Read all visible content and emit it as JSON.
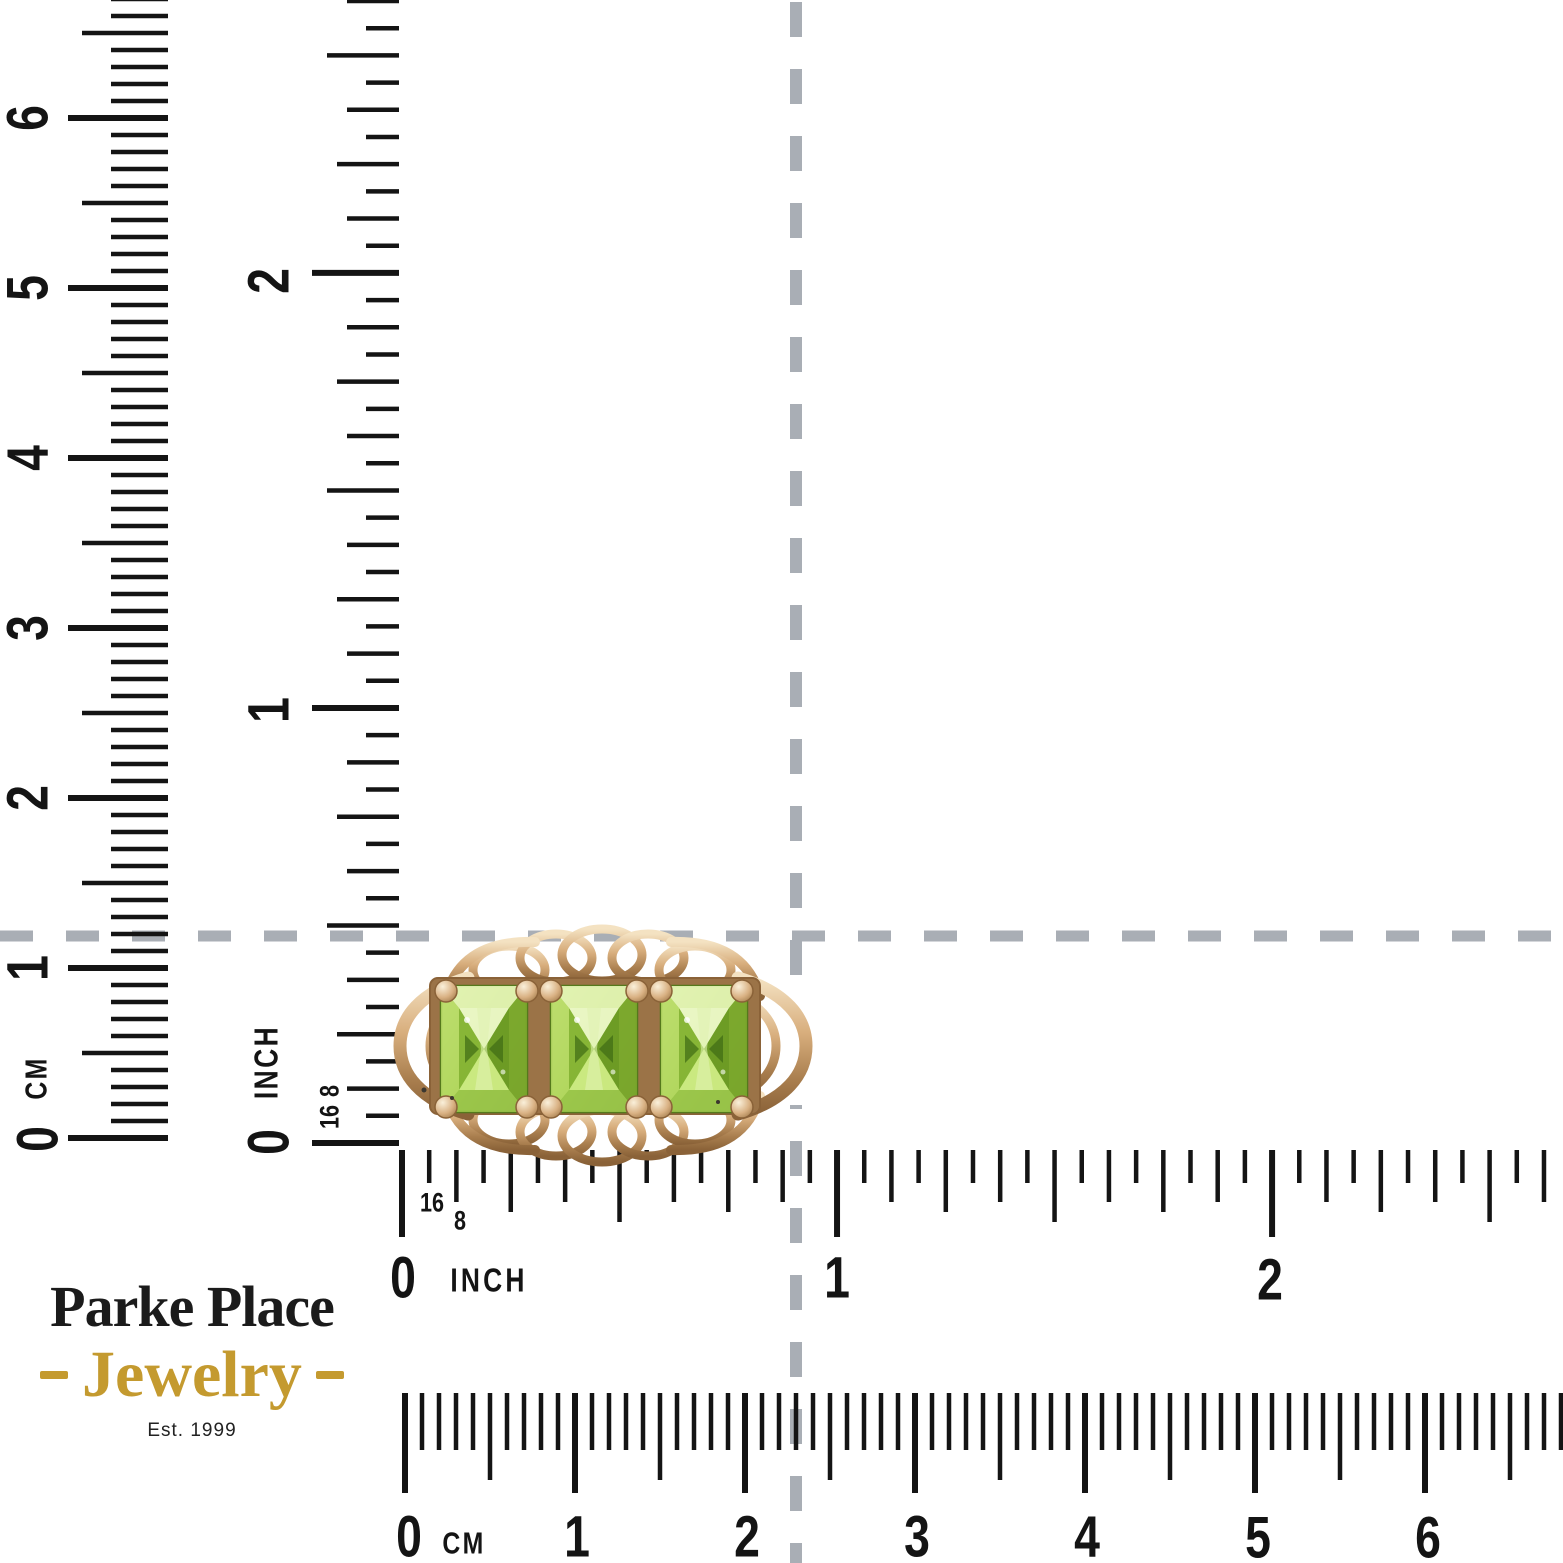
{
  "page": {
    "width": 1563,
    "height": 1563,
    "background": "#ffffff"
  },
  "brand": {
    "name_line": "Parke Place",
    "jewelry_line": "Jewelry",
    "established": "Est. 1999",
    "name_color": "#1b1b1b",
    "accent_color": "#c49a2f",
    "est_color": "#222222"
  },
  "crosshair": {
    "color": "#a9aeb5",
    "vertical": {
      "x": 796,
      "width": 12,
      "dash": 35,
      "gap": 32
    },
    "horizontal": {
      "y": 936,
      "width": 11,
      "dash": 33,
      "gap": 33
    }
  },
  "ring": {
    "description": "three-stone emerald-cut peridot ring in yellow gold",
    "stone_xs": [
      441,
      551,
      661
    ],
    "stone_w": 86,
    "stone_top": 986,
    "stone_bottom": 1112,
    "prong_xs": [
      446,
      527,
      551,
      637,
      661,
      742
    ],
    "prong_top_y": 991,
    "prong_bottom_y": 1107,
    "colors": {
      "gold_light": "#f4e2c2",
      "gold_mid": "#d8ae7d",
      "gold_deep": "#a97e4e",
      "gold_dark": "#8a6238",
      "stone_bright": "#e2f2b2",
      "stone_light": "#cdeb84",
      "stone_mid": "#8fbc3a",
      "stone_deep": "#6c9a24",
      "stone_dark": "#3e6b14",
      "plate": "#9b7347"
    }
  },
  "rulers": {
    "tick_color": "#141414",
    "left_cm": {
      "unit": "CM",
      "ticks": {
        "dir": "up",
        "edge": 168,
        "zero": 1138,
        "step": 17,
        "count": 68,
        "kind": "cm",
        "len": {
          "w": 100,
          "h": 86,
          "m": 57
        }
      },
      "labels": [
        {
          "t": "0",
          "x": 38,
          "y": 1139,
          "s": 58,
          "r": -90
        },
        {
          "t": "CM",
          "x": 36,
          "y": 1078,
          "s": 31,
          "r": -90,
          "ls": 3
        },
        {
          "t": "1",
          "x": 28,
          "y": 968,
          "s": 58,
          "r": -90
        },
        {
          "t": "2",
          "x": 28,
          "y": 798,
          "s": 58,
          "r": -90
        },
        {
          "t": "3",
          "x": 28,
          "y": 628,
          "s": 58,
          "r": -90
        },
        {
          "t": "4",
          "x": 28,
          "y": 458,
          "s": 58,
          "r": -90
        },
        {
          "t": "5",
          "x": 28,
          "y": 288,
          "s": 58,
          "r": -90
        },
        {
          "t": "6",
          "x": 28,
          "y": 118,
          "s": 58,
          "r": -90
        }
      ]
    },
    "left_inch": {
      "unit": "INCH",
      "ticks": {
        "dir": "up",
        "edge": 399,
        "zero": 1143,
        "step": 27.19,
        "count": 43,
        "kind": "inch",
        "len": {
          "w": 87,
          "h": 72,
          "q": 62,
          "e": 52,
          "s": 33
        }
      },
      "labels": [
        {
          "t": "0",
          "x": 269,
          "y": 1142,
          "s": 58,
          "r": -90
        },
        {
          "t": "INCH",
          "x": 267,
          "y": 1062,
          "s": 33,
          "r": -90,
          "ls": 3
        },
        {
          "t": "8",
          "x": 330,
          "y": 1091,
          "s": 27,
          "r": -90
        },
        {
          "t": "16",
          "x": 330,
          "y": 1117,
          "s": 27,
          "r": -90
        },
        {
          "t": "1",
          "x": 269,
          "y": 710,
          "s": 58,
          "r": -90
        },
        {
          "t": "2",
          "x": 269,
          "y": 281,
          "s": 58,
          "r": -90
        }
      ]
    },
    "bottom_inch": {
      "unit": "INCH",
      "ticks": {
        "dir": "right",
        "edge": 1150,
        "zero": 402,
        "step": 27.19,
        "count": 43,
        "kind": "inch",
        "len": {
          "w": 87,
          "h": 72,
          "q": 62,
          "e": 52,
          "s": 33
        }
      },
      "labels": [
        {
          "t": "0",
          "x": 403,
          "y": 1278,
          "s": 58
        },
        {
          "t": "INCH",
          "x": 489,
          "y": 1281,
          "s": 33,
          "ls": 4
        },
        {
          "t": "16",
          "x": 432,
          "y": 1203,
          "s": 27
        },
        {
          "t": "8",
          "x": 460,
          "y": 1221,
          "s": 27
        },
        {
          "t": "1",
          "x": 837,
          "y": 1278,
          "s": 58
        },
        {
          "t": "2",
          "x": 1270,
          "y": 1280,
          "s": 58
        }
      ]
    },
    "bottom_cm": {
      "unit": "CM",
      "ticks": {
        "dir": "right",
        "edge": 1393,
        "zero": 405,
        "step": 17,
        "count": 69,
        "kind": "cm",
        "len": {
          "w": 100,
          "h": 87,
          "m": 57
        }
      },
      "labels": [
        {
          "t": "0",
          "x": 409,
          "y": 1537,
          "s": 58
        },
        {
          "t": "CM",
          "x": 464,
          "y": 1543,
          "s": 31,
          "ls": 3
        },
        {
          "t": "1",
          "x": 577,
          "y": 1537,
          "s": 58
        },
        {
          "t": "2",
          "x": 747,
          "y": 1537,
          "s": 58
        },
        {
          "t": "3",
          "x": 917,
          "y": 1537,
          "s": 58
        },
        {
          "t": "4",
          "x": 1087,
          "y": 1537,
          "s": 58
        },
        {
          "t": "5",
          "x": 1258,
          "y": 1538,
          "s": 58
        },
        {
          "t": "6",
          "x": 1428,
          "y": 1538,
          "s": 58
        }
      ]
    }
  }
}
